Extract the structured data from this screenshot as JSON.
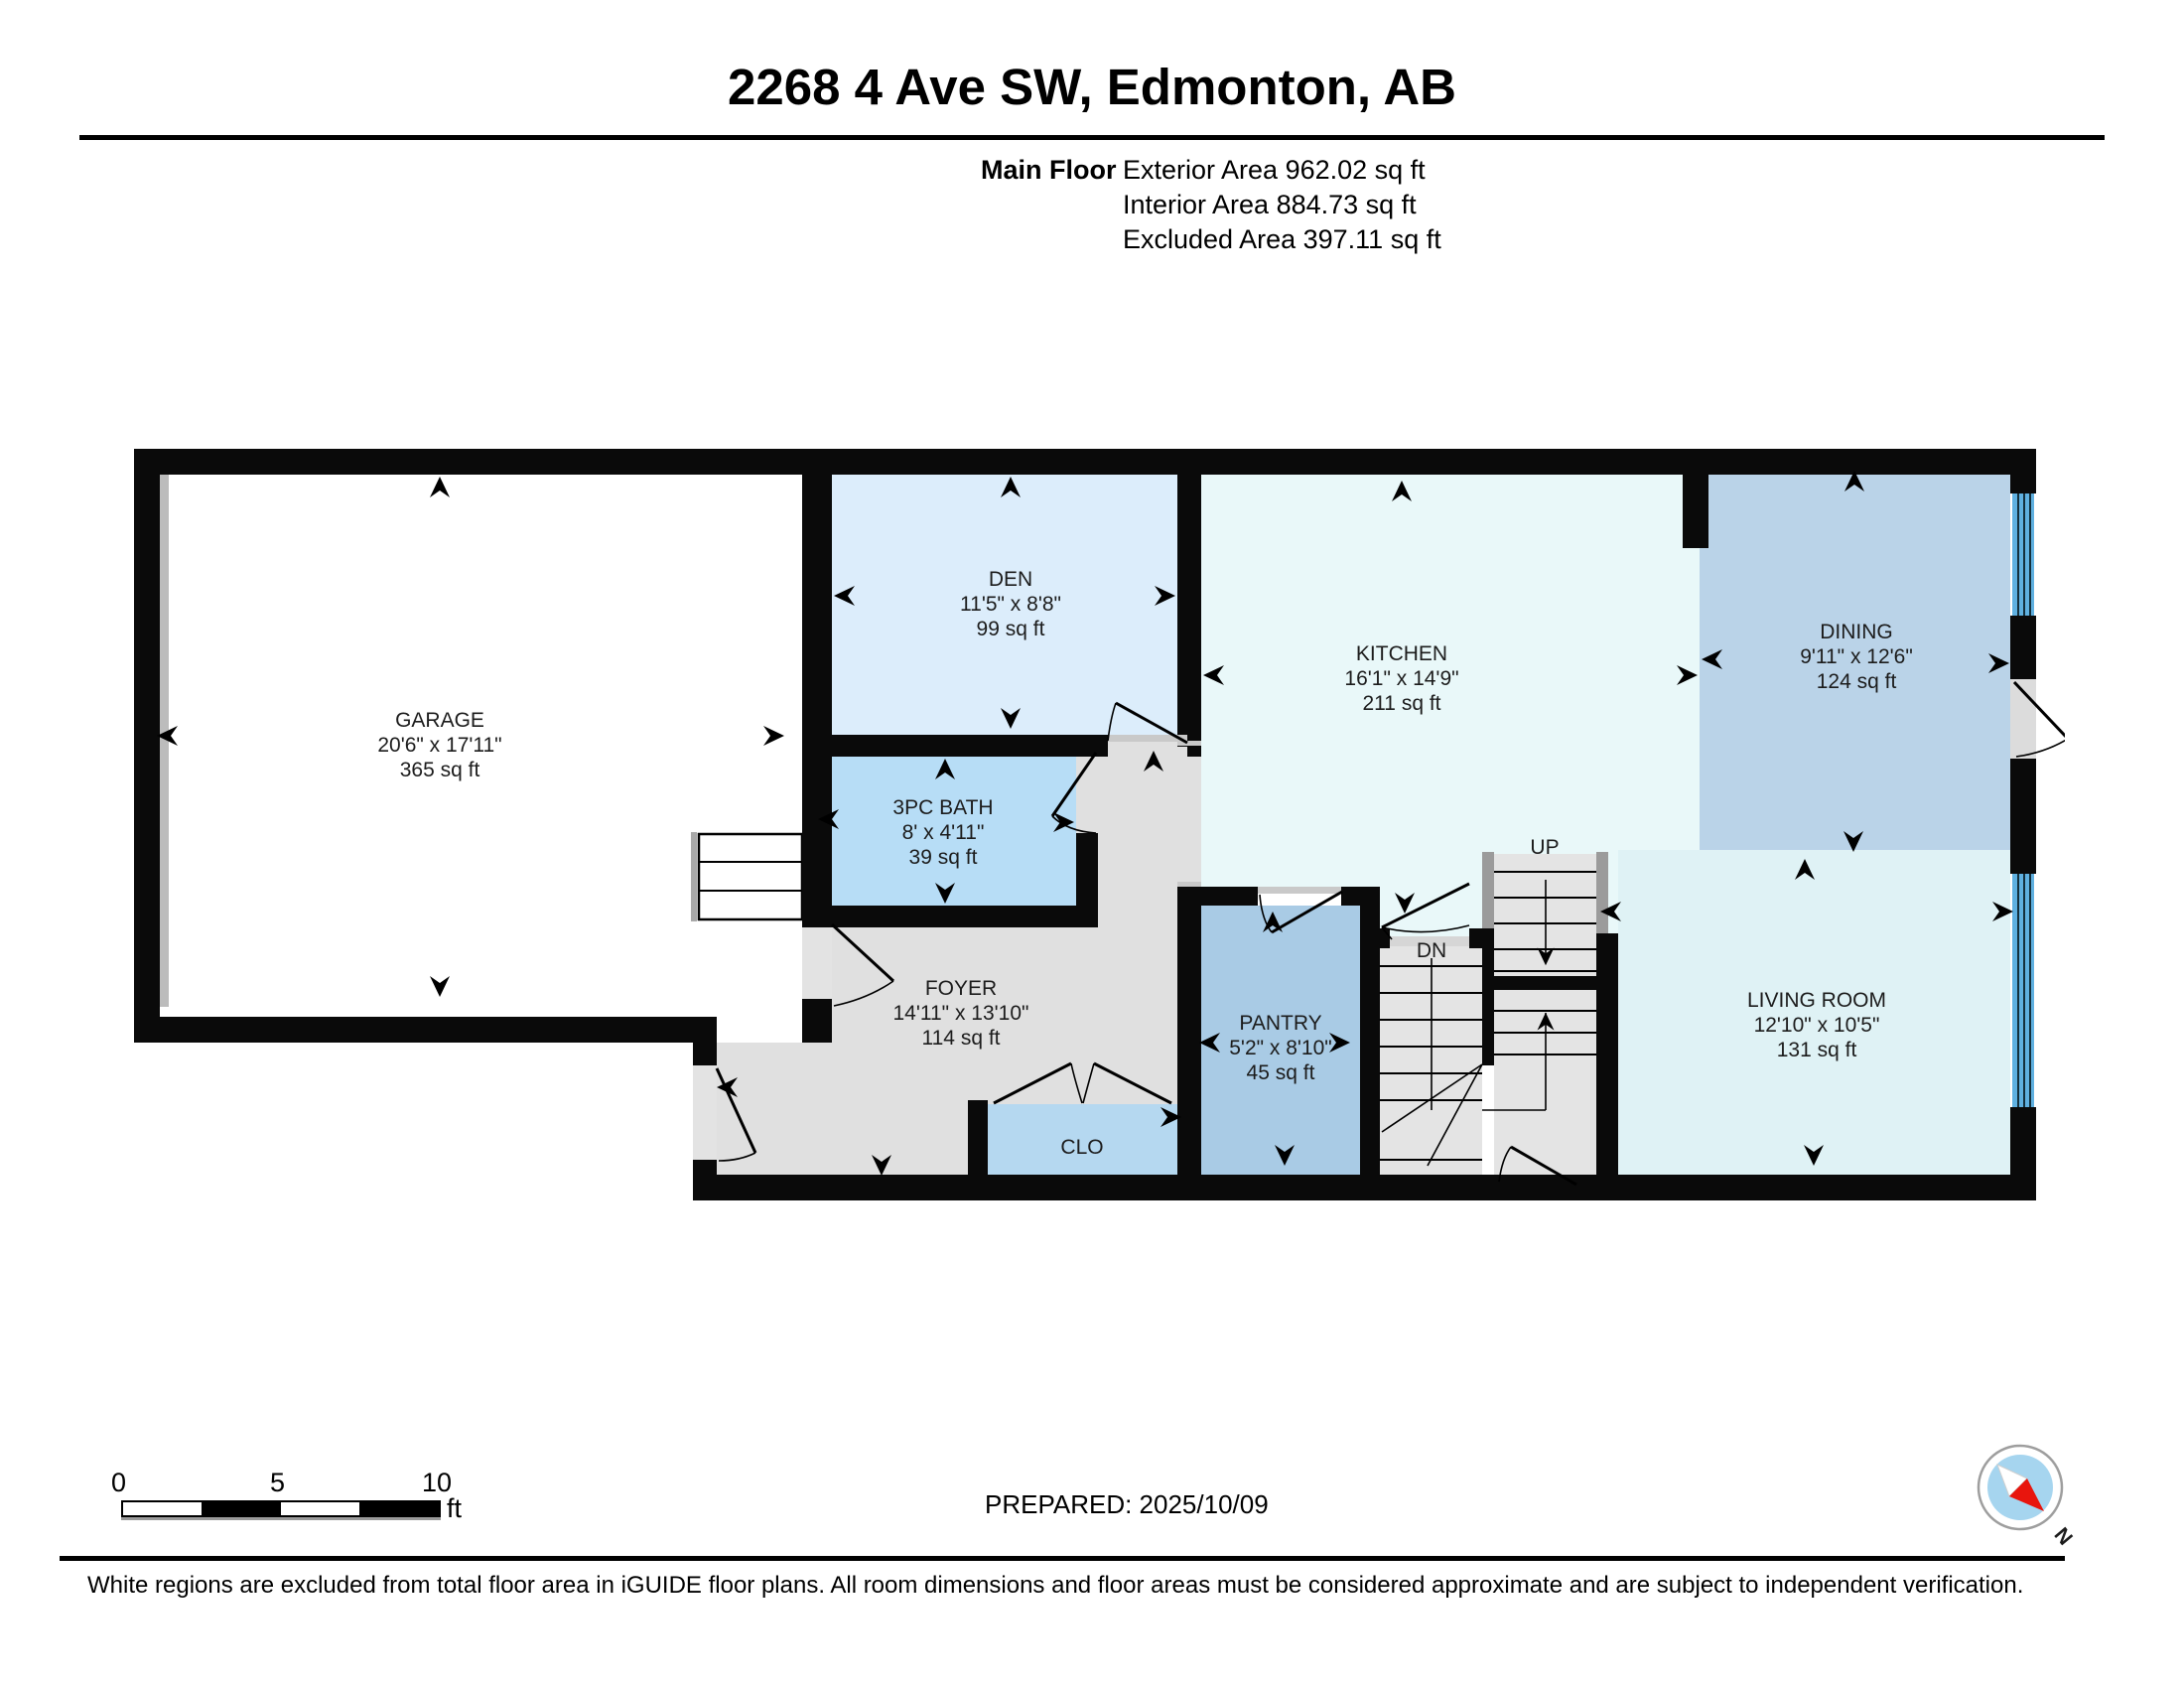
{
  "header": {
    "title": "2268 4 Ave SW, Edmonton, AB",
    "floor_label": "Main Floor",
    "exterior": "Exterior Area 962.02 sq ft",
    "interior": "Interior Area 884.73 sq ft",
    "excluded": "Excluded Area 397.11 sq ft"
  },
  "rooms": {
    "garage": {
      "name": "GARAGE",
      "dims": "20'6\" x 17'11\"",
      "area": "365 sq ft"
    },
    "den": {
      "name": "DEN",
      "dims": "11'5\" x 8'8\"",
      "area": "99 sq ft"
    },
    "bath": {
      "name": "3PC BATH",
      "dims": "8' x 4'11\"",
      "area": "39 sq ft"
    },
    "kitchen": {
      "name": "KITCHEN",
      "dims": "16'1\" x 14'9\"",
      "area": "211 sq ft"
    },
    "dining": {
      "name": "DINING",
      "dims": "9'11\" x 12'6\"",
      "area": "124 sq ft"
    },
    "foyer": {
      "name": "FOYER",
      "dims": "14'11\" x 13'10\"",
      "area": "114 sq ft"
    },
    "pantry": {
      "name": "PANTRY",
      "dims": "5'2\" x 8'10\"",
      "area": "45 sq ft"
    },
    "living": {
      "name": "LIVING ROOM",
      "dims": "12'10\" x 10'5\"",
      "area": "131 sq ft"
    },
    "closet": {
      "name": "CLO"
    }
  },
  "stairs": {
    "up": "UP",
    "down": "DN"
  },
  "scale_bar": {
    "t0": "0",
    "t1": "5",
    "t2": "10",
    "unit": "ft"
  },
  "compass": {
    "north": "N"
  },
  "footer": {
    "prepared": "PREPARED: 2025/10/09",
    "disclaimer": "White regions are excluded from total floor area in iGUIDE floor plans. All room dimensions and floor areas must be considered approximate and are subject to independent verification."
  },
  "colors": {
    "wall": "#0a0a0a",
    "den_fill": "#dcedfb",
    "bath_fill": "#b7ddf6",
    "kitchen_fill": "#e9f8f9",
    "dining_fill": "#bad3e8",
    "pantry_fill": "#a9cbe5",
    "closet_fill": "#b5d8f0",
    "living_fill": "#dff2f5",
    "foyer_fill": "#e0e0e0",
    "window_glass": "#5fb0e0",
    "compass_red": "#e8150d",
    "compass_blue": "#a6d5ef"
  }
}
